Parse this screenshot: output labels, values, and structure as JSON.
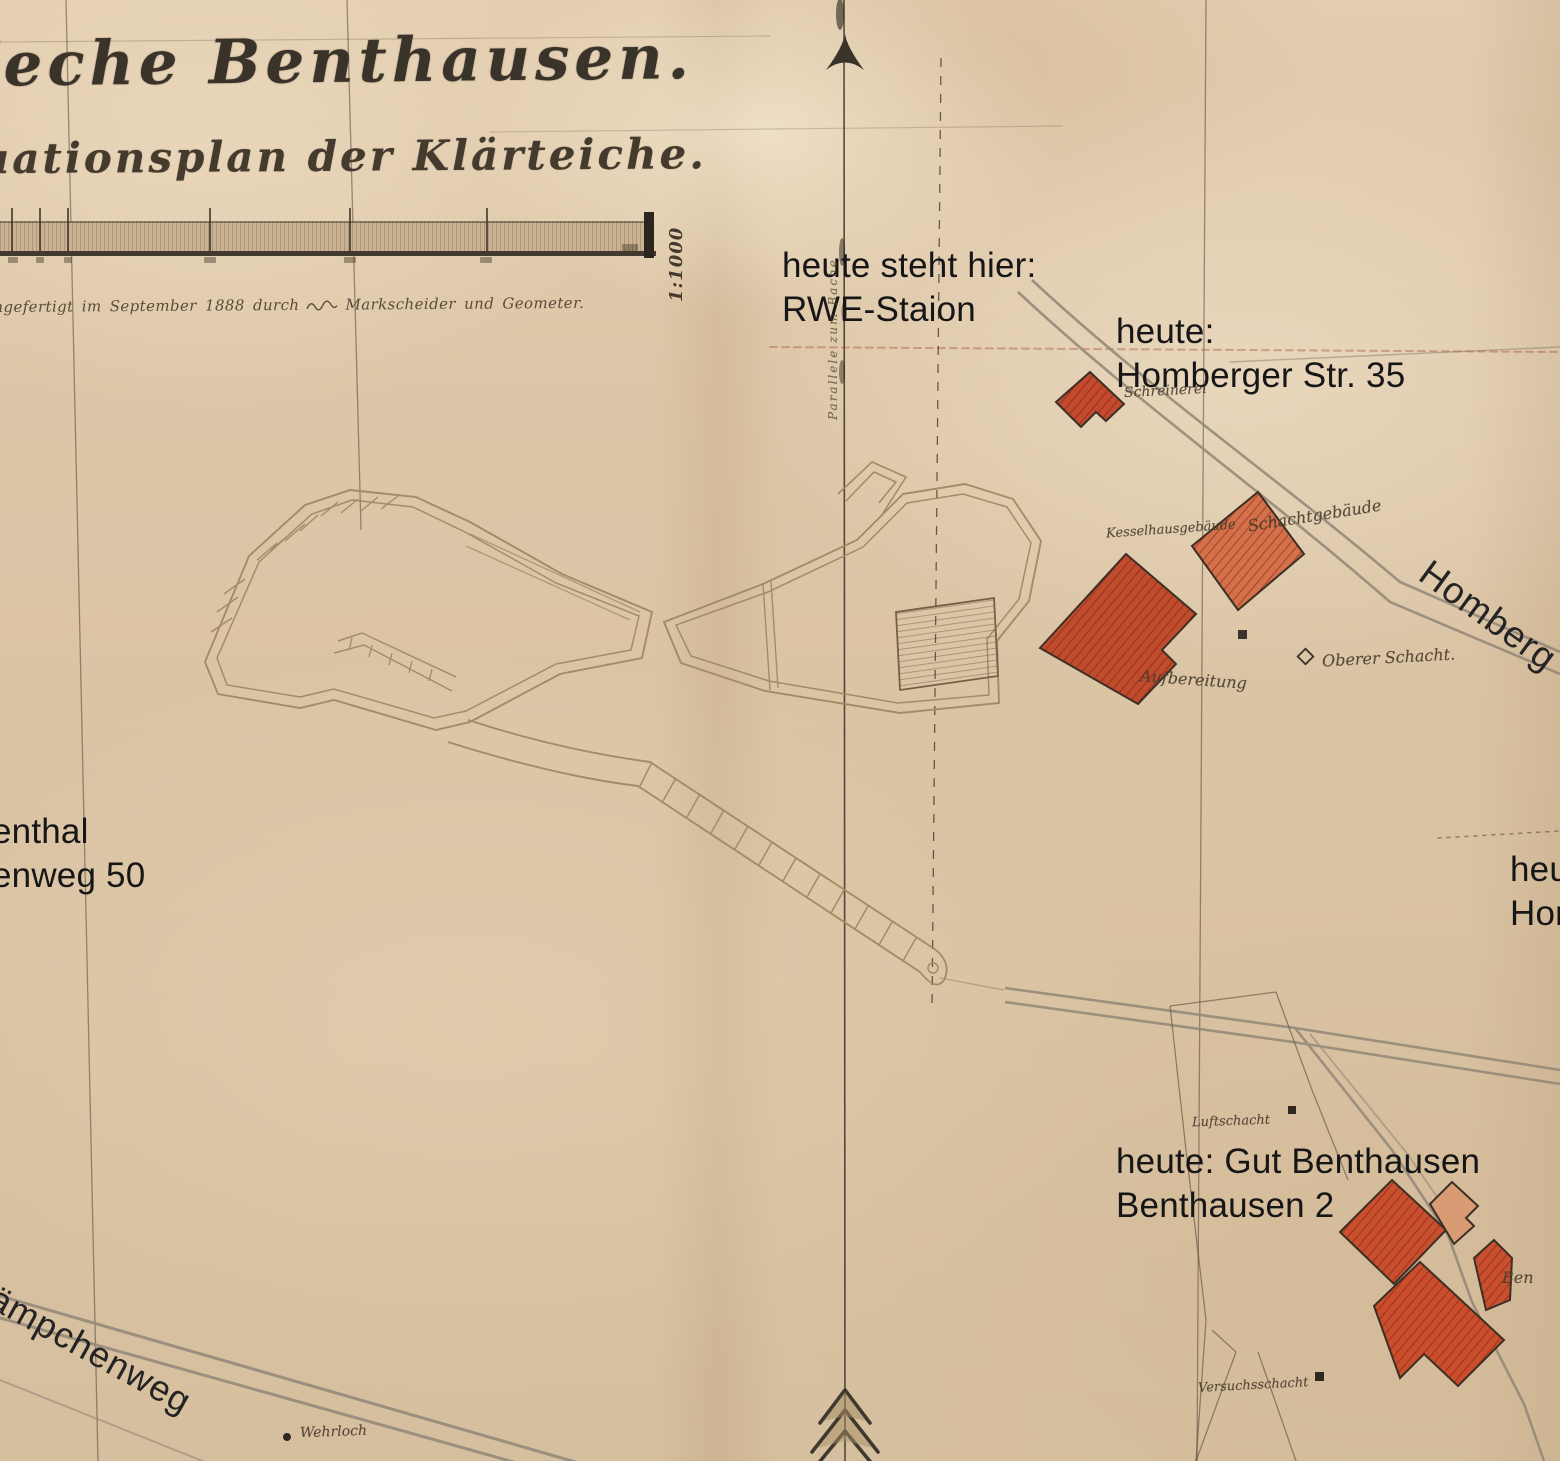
{
  "colors": {
    "paper": "#dcc5a6",
    "ink": "#3a332a",
    "pond_line": "#a08b64",
    "road_gray": "#95897a",
    "building_red": "#c24a2e",
    "building_light": "#d99b73",
    "annotation_black": "#1b1b1b"
  },
  "header": {
    "title": "Zeche Benthausen.",
    "subtitle": "Situationsplan der Klärteiche.",
    "scale_label": "1:1000",
    "credit_left": "angefertigt im September 1888 durch",
    "credit_right": "Markscheider und Geometer."
  },
  "annotations": {
    "rwe": {
      "line1": "heute steht hier:",
      "line2": "RWE-Staion"
    },
    "homberger35": {
      "line1": "heute:",
      "line2": "Homberger Str. 35"
    },
    "left_cut": {
      "line1": "enthal",
      "line2": "enweg 50"
    },
    "right_cut": {
      "line1": "heu",
      "line2": "Hor"
    },
    "gut_benthausen": {
      "line1": "heute: Gut Benthausen",
      "line2": "Benthausen 2"
    }
  },
  "streets": {
    "homberger": "Homberg",
    "kaempchenweg": "kämpchenweg"
  },
  "map_labels": {
    "schreinerei": "Schreinerei",
    "kesselhaus": "Kesselhausgebäude",
    "schachtgebaeude": "Schachtgebäude",
    "aufbereitung": "Aufbereitung",
    "oberer_schacht": "Oberer Schacht.",
    "luftschacht": "Luftschacht",
    "versuchsschacht": "Versuchsschacht",
    "wehrloch": "Wehrloch",
    "ben_cut": "Ben",
    "meridian_note": "Parallele zum Bache"
  }
}
